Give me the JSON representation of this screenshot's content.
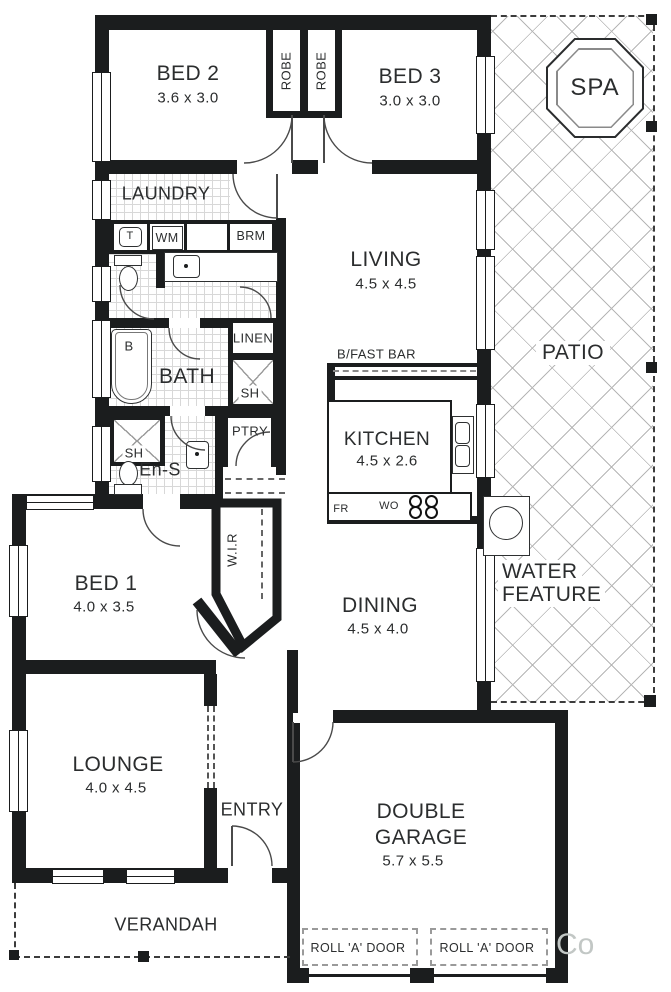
{
  "rooms": {
    "bed2": {
      "label": "BED 2",
      "dims": "3.6 x 3.0"
    },
    "bed3": {
      "label": "BED 3",
      "dims": "3.0 x 3.0"
    },
    "robe_left": "ROBE",
    "robe_right": "ROBE",
    "laundry": "LAUNDRY",
    "living": {
      "label": "LIVING",
      "dims": "4.5 x 4.5"
    },
    "patio": "PATIO",
    "spa": "SPA",
    "bath": "BATH",
    "linen": "LINEN",
    "bath_shower": "SH",
    "breakfast_bar": "B/FAST BAR",
    "kitchen": {
      "label": "KITCHEN",
      "dims": "4.5 x 2.6"
    },
    "ensuite": "En-S",
    "ensuite_shower": "SH",
    "pantry": "PTRY",
    "wir": "W.I.R",
    "bed1": {
      "label": "BED 1",
      "dims": "4.0 x 3.5"
    },
    "dining": {
      "label": "DINING",
      "dims": "4.5 x 4.0"
    },
    "water_feature": {
      "line1": "WATER",
      "line2": "FEATURE"
    },
    "lounge": {
      "label": "LOUNGE",
      "dims": "4.0 x 4.5"
    },
    "entry": "ENTRY",
    "garage": {
      "line1": "DOUBLE",
      "line2": "GARAGE",
      "dims": "5.7 x 5.5"
    },
    "verandah": "VERANDAH"
  },
  "fixtures": {
    "laundry_tub": "T",
    "washing_machine": "WM",
    "broom_cupboard": "BRM",
    "bath_tub": "B",
    "fridge": "FR",
    "wall_oven": "WO",
    "roll_door_left": "ROLL 'A' DOOR",
    "roll_door_right": "ROLL 'A' DOOR"
  },
  "watermark": "Co"
}
